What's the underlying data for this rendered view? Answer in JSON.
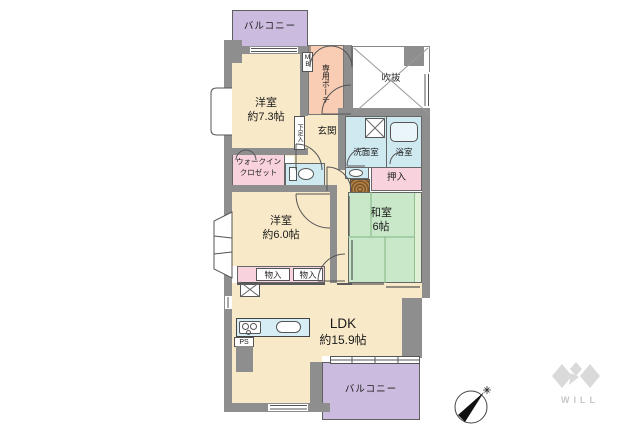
{
  "rooms": {
    "balcony_top": {
      "label": "バルコニー"
    },
    "bedroom_7_3": {
      "name": "洋室",
      "size": "約7.3帖"
    },
    "porch": {
      "label": "専用ポーチ"
    },
    "void": {
      "label": "吹抜"
    },
    "entrance": {
      "label": "玄関"
    },
    "washroom": {
      "label": "洗面室"
    },
    "bathroom": {
      "label": "浴室"
    },
    "oshiire": {
      "label": "押入"
    },
    "washitsu": {
      "name": "和室",
      "size": "6帖"
    },
    "wic": {
      "line1": "ウォークイン",
      "line2": "クロゼット"
    },
    "bedroom_6_0": {
      "name": "洋室",
      "size": "約6.0帖"
    },
    "storage_left": {
      "label": "物入"
    },
    "storage_right": {
      "label": "物入"
    },
    "ldk": {
      "name": "LDK",
      "size": "約15.9帖"
    },
    "balcony_bottom": {
      "label": "バルコニー"
    }
  },
  "labels": {
    "meter_box": "MB",
    "shoe_cabinet": "下足入",
    "pipe_space": "PS"
  },
  "logo": {
    "text": "WILL"
  },
  "colors": {
    "room_cream": "#f8e9c8",
    "balcony_purple": "#cbbcdf",
    "porch_salmon": "#f9cdb3",
    "water_blue": "#cfe9f1",
    "closet_pink": "#f8d3de",
    "tatami_green": "#c9e7c9",
    "tatami_edge": "#dff0d6",
    "wall_gray": "#8e8e8e",
    "line": "#4d4d4d"
  }
}
